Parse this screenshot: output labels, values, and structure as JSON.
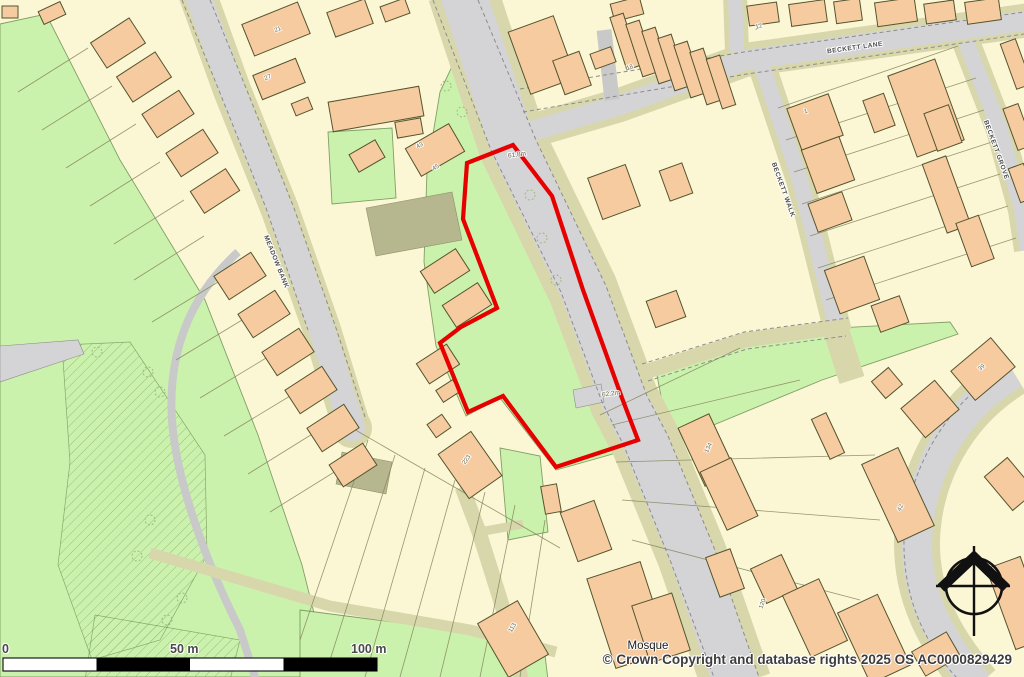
{
  "attribution": {
    "text": "© Crown Copyright and database rights 2025 OS AC0000829429"
  },
  "scale_bar": {
    "labels": [
      "0",
      "50 m",
      "100 m"
    ],
    "total_metres": 100,
    "segments": 4
  },
  "labels": {
    "streets": [
      {
        "text": "MEADOW BANK",
        "x": 276,
        "y": 262,
        "r": 68
      },
      {
        "text": "BECKETT LANE",
        "x": 855,
        "y": 48,
        "r": -8
      },
      {
        "text": "BECKETT WALK",
        "x": 783,
        "y": 190,
        "r": 70
      },
      {
        "text": "BECKETT GROVE",
        "x": 996,
        "y": 150,
        "r": 70
      }
    ],
    "places": [
      {
        "text": "Mosque",
        "x": 648,
        "y": 646,
        "r": 0
      }
    ],
    "spot_heights": [
      {
        "text": "61.8m",
        "x": 517,
        "y": 155,
        "r": -8
      },
      {
        "text": "62.2m",
        "x": 611,
        "y": 394,
        "r": -8
      }
    ],
    "building_numbers": [
      {
        "text": "21",
        "x": 278,
        "y": 30,
        "r": -22
      },
      {
        "text": "27",
        "x": 268,
        "y": 78,
        "r": -22
      },
      {
        "text": "43",
        "x": 420,
        "y": 146,
        "r": -30
      },
      {
        "text": "45",
        "x": 436,
        "y": 168,
        "r": -30
      },
      {
        "text": "18",
        "x": 630,
        "y": 68,
        "r": -18
      },
      {
        "text": "12",
        "x": 759,
        "y": 27,
        "r": -15
      },
      {
        "text": "1",
        "x": 806,
        "y": 112,
        "r": -20
      },
      {
        "text": "134",
        "x": 709,
        "y": 448,
        "r": -65
      },
      {
        "text": "42",
        "x": 901,
        "y": 508,
        "r": -65
      },
      {
        "text": "39",
        "x": 982,
        "y": 368,
        "r": -40
      },
      {
        "text": "223",
        "x": 467,
        "y": 460,
        "r": -55
      },
      {
        "text": "113",
        "x": 513,
        "y": 628,
        "r": -60
      },
      {
        "text": "120",
        "x": 763,
        "y": 604,
        "r": -70
      }
    ]
  },
  "colors": {
    "background": "#FBF7D5",
    "green": "#CBF2AD",
    "green_edge": "#5A7A40",
    "building": "#F7CBA0",
    "building_edge": "#54542E",
    "road": "#D4D4D6",
    "minor_road": "#C9C9C9",
    "verge": "#D8D7AC",
    "khaki": "#B7B78F",
    "parcel_line": "#85855C",
    "road_edge_dash": "#8C8C8C",
    "hatch": "#9DBA7F",
    "boundary_red": "#E60000",
    "scalebar_black": "#000000",
    "compass_black": "#111111"
  },
  "map": {
    "site_boundary": [
      513,
      145,
      467,
      163,
      463,
      219,
      497,
      308,
      461,
      327,
      440,
      343,
      468,
      412,
      503,
      396,
      556,
      467,
      638,
      440,
      622,
      398,
      583,
      290,
      552,
      196
    ],
    "greens": [
      "0,24 46,14 120,160 205,300 258,435 302,565 330,677 0,677",
      "440,92 470,28 482,26 516,140 585,288 641,420 641,446 556,470 500,398 466,416 436,346 424,262 427,170",
      "655,365 760,332 950,322 958,334 822,380 670,443",
      "328,132 392,128 396,198 332,204",
      "300,610 470,632 545,655 548,680 300,680",
      "500,448 540,456 548,532 508,540"
    ],
    "hatches": [
      "62,345 130,342 205,455 207,555 160,640 92,660 58,565 70,462",
      "95,615 240,640 230,680 85,680"
    ],
    "khaki_areas": [
      "366,208 452,192 462,240 376,256",
      "342,452 392,462 386,494 336,484"
    ],
    "gray_areas": [
      "0,346 78,340 84,354 0,382",
      "573,390 601,384 604,402 576,408"
    ],
    "roads": [
      {
        "d": "M 462,-10 L 513,145 L 583,290 L 624,400 L 645,440 L 692,555 L 737,685",
        "w": 46,
        "v": 70
      },
      {
        "d": "M 528,132 L 620,105 L 745,60 L 1030,20",
        "w": 20,
        "v": 34
      },
      {
        "d": "M 762,66 L 800,180 L 838,332",
        "w": 16,
        "v": 28
      },
      {
        "d": "M 735,-5 L 737,52",
        "w": 14,
        "v": 24
      },
      {
        "d": "M 966,42 L 1000,130 L 1022,210 L 1028,250",
        "w": 16,
        "v": 28
      },
      {
        "d": "M 196,-10 L 232,90 L 280,210 L 322,330 L 352,428",
        "w": 26,
        "v": 38
      },
      {
        "d": "M 1014,373 C 950,412 919,478 917,540 C 916,592 936,636 978,685",
        "w": 30,
        "v": 46
      }
    ],
    "minor_roads": [
      {
        "d": "M 604,30 L 612,100",
        "w": 15
      },
      {
        "d": "M 238,252 C 185,300 168,360 172,420 C 176,480 205,560 240,630 L 256,680",
        "w": 8
      }
    ],
    "tracks": [
      {
        "d": "M 645,372 L 745,340 L 847,326",
        "w": 15
      },
      {
        "d": "M 462,487 L 479,532 L 501,602 L 517,657 L 521,680",
        "w": 15
      },
      {
        "d": "M 479,532 L 523,524",
        "w": 9
      },
      {
        "d": "M 150,553 L 330,606 L 470,630 L 556,652",
        "w": 11
      },
      {
        "d": "M 836,330 L 852,380",
        "w": 26
      }
    ],
    "caps": {
      "cx": 352,
      "cy": 428,
      "rv": 20,
      "rr": 13
    },
    "edges": [
      "M 433,0 L 491,150 L 561,292 L 602,402 L 624,446 L 670,560 L 715,680",
      "M 478,0 L 536,140 L 606,286 L 647,396 L 668,436 L 715,550 L 760,680",
      "M 520,89 L 744,52 L 1024,12",
      "M 523,112 L 747,74 L 1024,34",
      "M 210,0 L 246,88 L 294,208 L 336,328 L 366,420",
      "M 182,0 L 218,88 L 266,208 L 308,330",
      "M 1001,371 C 941,409 906,477 904,540 C 903,594 922,642 959,680",
      "M 642,364 L 744,332 L 848,318",
      "M 648,381 L 747,349 L 846,336"
    ],
    "parcel_lines": [
      [
        88,
        48,
        18,
        92
      ],
      [
        112,
        86,
        42,
        130
      ],
      [
        136,
        124,
        66,
        168
      ],
      [
        160,
        162,
        90,
        206
      ],
      [
        184,
        200,
        114,
        244
      ],
      [
        204,
        236,
        134,
        280
      ],
      [
        228,
        276,
        152,
        322
      ],
      [
        252,
        314,
        176,
        360
      ],
      [
        276,
        352,
        200,
        398
      ],
      [
        300,
        390,
        224,
        436
      ],
      [
        322,
        428,
        248,
        474
      ],
      [
        344,
        466,
        270,
        512
      ],
      [
        352,
        428,
        560,
        548
      ],
      [
        368,
        440,
        300,
        640
      ],
      [
        395,
        455,
        330,
        660
      ],
      [
        425,
        468,
        365,
        677
      ],
      [
        455,
        480,
        400,
        677
      ],
      [
        485,
        492,
        440,
        677
      ],
      [
        515,
        505,
        480,
        677
      ],
      [
        545,
        520,
        520,
        677
      ],
      [
        612,
        425,
        800,
        380
      ],
      [
        616,
        462,
        875,
        455
      ],
      [
        622,
        500,
        880,
        520
      ],
      [
        632,
        540,
        860,
        600
      ],
      [
        600,
        415,
        740,
        348
      ],
      [
        778,
        108,
        958,
        46
      ],
      [
        786,
        140,
        976,
        78
      ],
      [
        794,
        172,
        984,
        110
      ],
      [
        802,
        204,
        992,
        142
      ],
      [
        810,
        236,
        1000,
        174
      ],
      [
        818,
        268,
        1008,
        206
      ],
      [
        826,
        300,
        1016,
        238
      ],
      [
        756,
        30,
        760,
        6
      ],
      [
        800,
        26,
        804,
        2
      ],
      [
        848,
        22,
        852,
        0
      ],
      [
        896,
        18,
        900,
        0
      ],
      [
        944,
        14,
        948,
        0
      ],
      [
        992,
        10,
        996,
        0
      ]
    ],
    "trees": [
      [
        148,
        372
      ],
      [
        160,
        392
      ],
      [
        150,
        520
      ],
      [
        137,
        556
      ],
      [
        182,
        598
      ],
      [
        167,
        620
      ],
      [
        97,
        352
      ],
      [
        446,
        86
      ],
      [
        462,
        112
      ],
      [
        530,
        195
      ],
      [
        542,
        238
      ],
      [
        556,
        280
      ]
    ],
    "buildings": [
      [
        95,
        28,
        46,
        30,
        -33
      ],
      [
        121,
        62,
        46,
        30,
        -33
      ],
      [
        146,
        100,
        44,
        28,
        -33
      ],
      [
        170,
        139,
        44,
        28,
        -33
      ],
      [
        194,
        178,
        42,
        26,
        -33
      ],
      [
        218,
        262,
        44,
        28,
        -33
      ],
      [
        242,
        300,
        44,
        28,
        -33
      ],
      [
        266,
        338,
        44,
        28,
        -33
      ],
      [
        289,
        376,
        44,
        28,
        -33
      ],
      [
        311,
        414,
        44,
        28,
        -33
      ],
      [
        333,
        452,
        40,
        26,
        -33
      ],
      [
        2,
        6,
        16,
        12,
        0
      ],
      [
        40,
        6,
        24,
        14,
        -25
      ],
      [
        246,
        12,
        60,
        34,
        -22
      ],
      [
        256,
        66,
        46,
        26,
        -22
      ],
      [
        293,
        100,
        18,
        13,
        -22
      ],
      [
        330,
        94,
        92,
        30,
        -10
      ],
      [
        396,
        120,
        26,
        16,
        -10
      ],
      [
        410,
        134,
        50,
        32,
        -30
      ],
      [
        352,
        146,
        30,
        20,
        -30
      ],
      [
        330,
        5,
        40,
        26,
        -20
      ],
      [
        382,
        2,
        26,
        16,
        -20
      ],
      [
        424,
        258,
        42,
        26,
        -33
      ],
      [
        446,
        292,
        42,
        26,
        -33
      ],
      [
        420,
        352,
        36,
        24,
        -33
      ],
      [
        438,
        384,
        20,
        14,
        -33
      ],
      [
        518,
        22,
        48,
        66,
        -20
      ],
      [
        558,
        55,
        28,
        36,
        -20
      ],
      [
        592,
        50,
        22,
        16,
        -20
      ],
      [
        612,
        0,
        30,
        18,
        -15
      ],
      [
        618,
        14,
        14,
        55,
        -18
      ],
      [
        634,
        21,
        14,
        55,
        -18
      ],
      [
        650,
        28,
        14,
        55,
        -18
      ],
      [
        666,
        35,
        14,
        55,
        -18
      ],
      [
        682,
        42,
        14,
        55,
        -18
      ],
      [
        698,
        49,
        14,
        55,
        -18
      ],
      [
        714,
        56,
        14,
        52,
        -18
      ],
      [
        594,
        170,
        40,
        44,
        -20
      ],
      [
        664,
        166,
        24,
        32,
        -20
      ],
      [
        650,
        295,
        32,
        28,
        -20
      ],
      [
        748,
        4,
        30,
        20,
        -8
      ],
      [
        790,
        2,
        36,
        22,
        -8
      ],
      [
        835,
        0,
        26,
        22,
        -8
      ],
      [
        876,
        0,
        40,
        24,
        -8
      ],
      [
        925,
        2,
        30,
        20,
        -8
      ],
      [
        966,
        0,
        34,
        22,
        -8
      ],
      [
        793,
        100,
        44,
        44,
        -20
      ],
      [
        808,
        142,
        40,
        46,
        -20
      ],
      [
        812,
        197,
        36,
        30,
        -20
      ],
      [
        831,
        262,
        42,
        46,
        -20
      ],
      [
        901,
        65,
        50,
        86,
        -20
      ],
      [
        930,
        108,
        26,
        40,
        -20
      ],
      [
        934,
        158,
        25,
        73,
        -20
      ],
      [
        963,
        218,
        24,
        46,
        -20
      ],
      [
        875,
        300,
        30,
        28,
        -20
      ],
      [
        868,
        96,
        22,
        34,
        -20
      ],
      [
        1008,
        40,
        16,
        48,
        -20
      ],
      [
        1010,
        105,
        16,
        44,
        -20
      ],
      [
        1014,
        165,
        16,
        36,
        -20
      ],
      [
        957,
        350,
        52,
        38,
        -40
      ],
      [
        908,
        390,
        44,
        38,
        -40
      ],
      [
        876,
        372,
        22,
        22,
        -40
      ],
      [
        820,
        414,
        16,
        44,
        -25
      ],
      [
        690,
        418,
        34,
        64,
        -25
      ],
      [
        712,
        462,
        34,
        64,
        -25
      ],
      [
        878,
        452,
        40,
        86,
        -25
      ],
      [
        995,
        462,
        30,
        44,
        -40
      ],
      [
        757,
        560,
        34,
        38,
        -25
      ],
      [
        795,
        584,
        40,
        68,
        -25
      ],
      [
        852,
        600,
        44,
        78,
        -25
      ],
      [
        1000,
        560,
        36,
        86,
        -20
      ],
      [
        916,
        640,
        40,
        28,
        -30
      ],
      [
        600,
        568,
        56,
        94,
        -18
      ],
      [
        640,
        598,
        42,
        60,
        -18
      ],
      [
        568,
        505,
        36,
        52,
        -20
      ],
      [
        543,
        485,
        16,
        28,
        -10
      ],
      [
        450,
        438,
        40,
        54,
        -35
      ],
      [
        430,
        418,
        18,
        16,
        -35
      ],
      [
        490,
        608,
        46,
        62,
        -30
      ],
      [
        712,
        552,
        26,
        42,
        -20
      ]
    ],
    "compass": {
      "cx": 974,
      "cy": 586,
      "r": 28
    },
    "scalebar": {
      "x": 3,
      "y": 658,
      "w": 374,
      "h": 13
    }
  }
}
